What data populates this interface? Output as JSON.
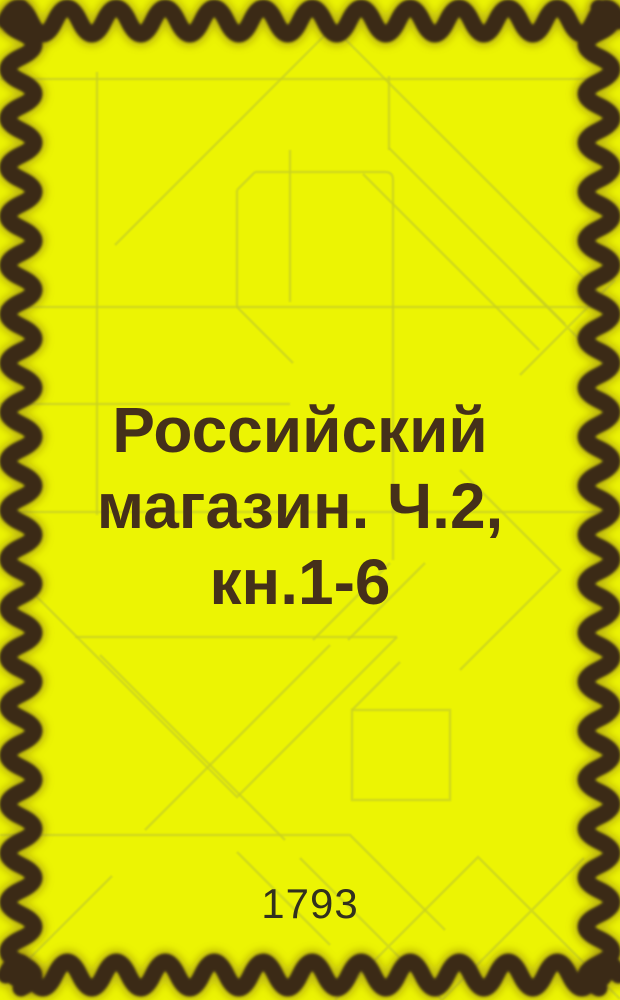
{
  "cover": {
    "title": "Российский магазин. Ч.2, кн.1-6",
    "title_lines": [
      "Российский",
      "магазин. Ч.2,",
      "кн.1-6"
    ],
    "year": "1793",
    "colors": {
      "background": "#ecf403",
      "border_wave": "#3b2a12",
      "title_text": "#45301a",
      "year_text": "#32301e",
      "pattern_line": "#c9d120"
    }
  }
}
